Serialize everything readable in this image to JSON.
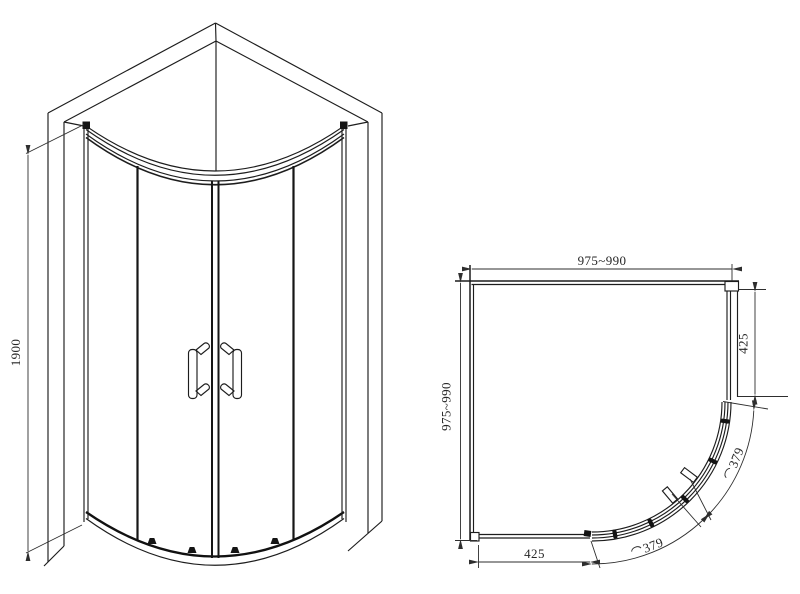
{
  "page": {
    "background": "#ffffff"
  },
  "drawing": {
    "type": "shower-enclosure-technical-drawing",
    "line_color": "#1d1d1d",
    "text_color": "#262626",
    "front_view": {
      "dim_height": "1900"
    },
    "plan_view": {
      "dim_top_width": "975~990",
      "dim_left_depth": "975~990",
      "dim_right_panel": "425",
      "dim_bottom_panel": "425",
      "dim_arc_upper": "379",
      "dim_arc_lower": "379"
    },
    "icons": {
      "arc_length_symbol": "⌒"
    }
  }
}
